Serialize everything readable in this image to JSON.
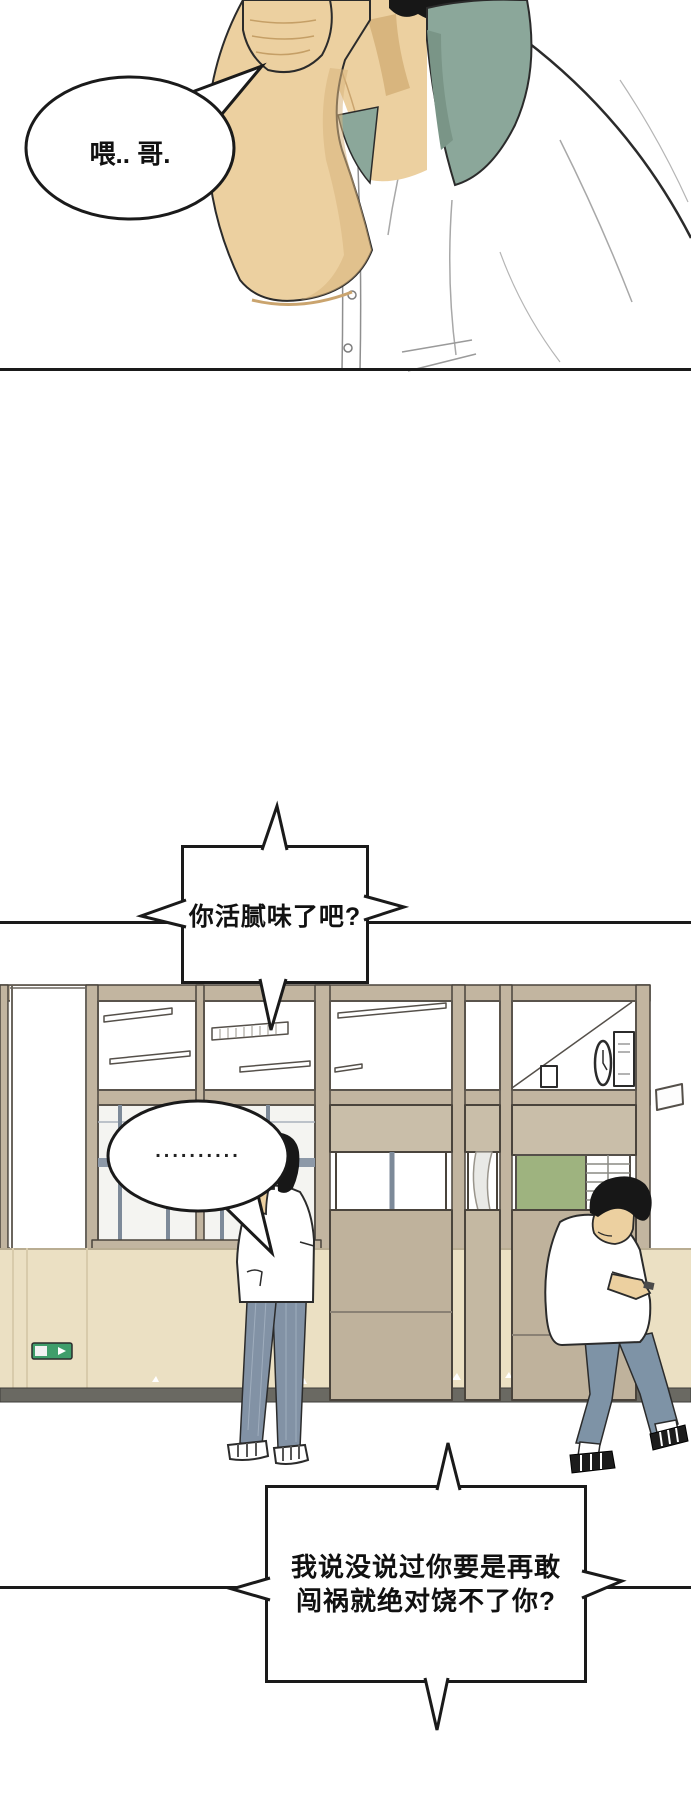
{
  "page": {
    "type": "webtoon-comic-page",
    "language": "zh",
    "background_color": "#ffffff"
  },
  "panels": [
    {
      "id": "panel-1",
      "description": "close-up of a young man in a white shirt with a green collar holding a phone to his ear"
    },
    {
      "id": "panel-2",
      "description": "school corridor with window wall; a boy stands talking on the phone while another boy walks past looking down at his phone"
    }
  ],
  "speech_bubbles": [
    {
      "id": "bubble-1",
      "shape": "ellipse",
      "text": "喂.. 哥."
    },
    {
      "id": "bubble-2",
      "shape": "rectangle-spiked",
      "text": "你活腻味了吧?"
    },
    {
      "id": "bubble-3",
      "shape": "ellipse",
      "text": ".........."
    },
    {
      "id": "bubble-4",
      "shape": "rectangle-spiked",
      "lines": [
        "我说没说过你要是再敢",
        "闯祸就绝对饶不了你?"
      ]
    }
  ],
  "scene_elements": {
    "exit_sign": {
      "label": "exit-sign",
      "color": "#3f9e6b"
    },
    "green_board_color": "#9eb37f",
    "window_frame_color": "#c2b5a0",
    "door_panel_color": "#bfb29c",
    "wainscot_color": "#ebe0c3",
    "baseboard_color": "#6a6962",
    "collar_color": "#8ba79a",
    "skin_color": "#ecd0a0",
    "hair_color": "#171717",
    "pants_color": "#8292a5",
    "outline_color": "#1a1a1a"
  }
}
